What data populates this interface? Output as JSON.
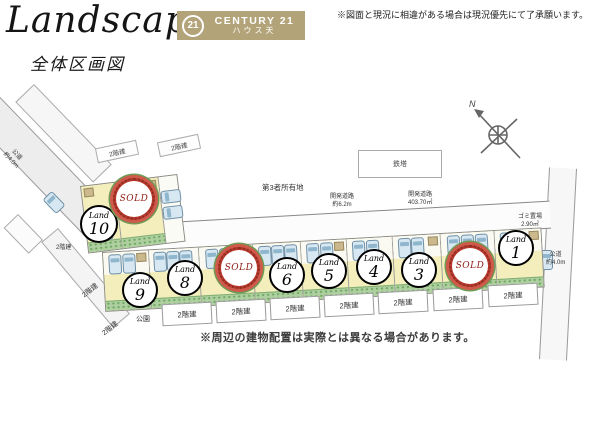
{
  "header": {
    "title": "Landscape",
    "subtitle": "全体区画図",
    "brand": {
      "logo": "21",
      "name": "CENTURY 21",
      "branch": "ハウス天"
    },
    "disclaimer": "※図面と現況に相違がある場合は現況優先にて了承願います。"
  },
  "map": {
    "land_word": "Land",
    "sold_label": "SOLD",
    "plots_upper": [
      {
        "kind": "land",
        "number": "10"
      },
      {
        "kind": "sold"
      }
    ],
    "plots_row": [
      {
        "kind": "land",
        "number": "9"
      },
      {
        "kind": "land",
        "number": "8"
      },
      {
        "kind": "sold"
      },
      {
        "kind": "land",
        "number": "6"
      },
      {
        "kind": "land",
        "number": "5"
      },
      {
        "kind": "land",
        "number": "4"
      },
      {
        "kind": "land",
        "number": "3"
      },
      {
        "kind": "sold"
      },
      {
        "kind": "land",
        "number": "1"
      }
    ],
    "labels": {
      "two_story": "2階建",
      "park": "公園",
      "third_party_land": "第3者所有地",
      "tower": "鉄塔",
      "public_road": "公道",
      "public_road_width": "約4.0m",
      "dev_road": "開発道路",
      "dev_road_width": "約6.2m",
      "dev_road_area": "403.70㎡",
      "garbage_place": "ゴミ置場",
      "garbage_area": "2.90㎡",
      "north": "N"
    },
    "note": "※周辺の建物配置は実際とは異なる場合があります。"
  },
  "colors": {
    "brand_tan": "#b3a379",
    "plot_yellow": "#f3eebb",
    "hedge_green": "#aecfa0",
    "sold_red": "#c0392b",
    "car_blue": "#d7e8f2"
  }
}
